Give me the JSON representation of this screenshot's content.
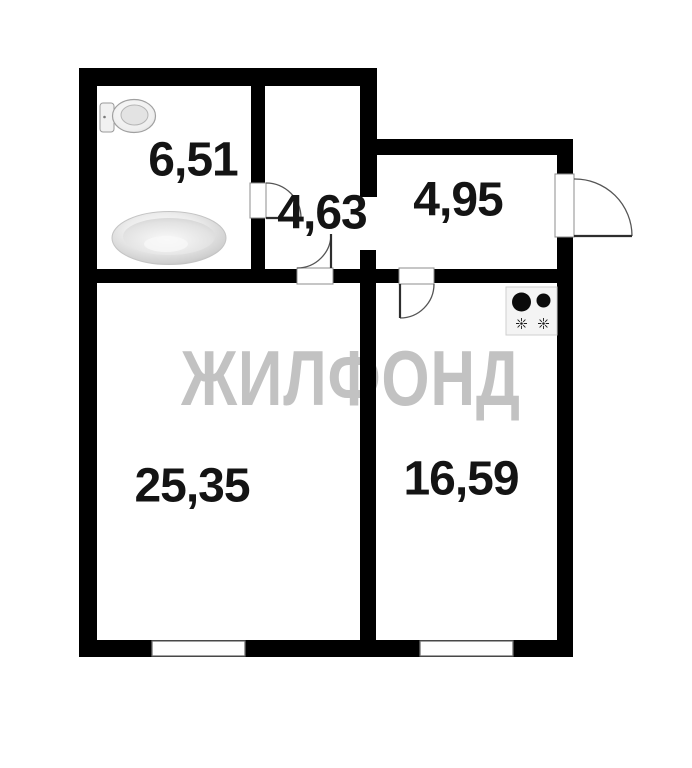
{
  "watermark": {
    "text": "ЖИЛФОНД",
    "color": "#c2c2c2"
  },
  "rooms": {
    "bathroom": {
      "area": "6,51"
    },
    "hallway": {
      "area": "4,63"
    },
    "entry": {
      "area": "4,95"
    },
    "living": {
      "area": "25,35"
    },
    "kitchen": {
      "area": "16,59"
    }
  },
  "fixtures": {
    "toilet": "toilet-icon",
    "bathtub": "bathtub-icon",
    "stove": "stove-icon"
  },
  "openings": {
    "doors": [
      "bathroom-door",
      "hallway-door",
      "kitchen-door",
      "entrance-door"
    ],
    "windows": [
      "living-room-window",
      "kitchen-window"
    ],
    "passage": "hallway-entry-passage"
  },
  "colors": {
    "walls": "#000000",
    "background": "#ffffff",
    "door_lines": "#2e2e2e",
    "arc_lines": "#555555",
    "window_frame": "#6f6f6f",
    "watermark": "#c2c2c2",
    "text": "#141414"
  }
}
